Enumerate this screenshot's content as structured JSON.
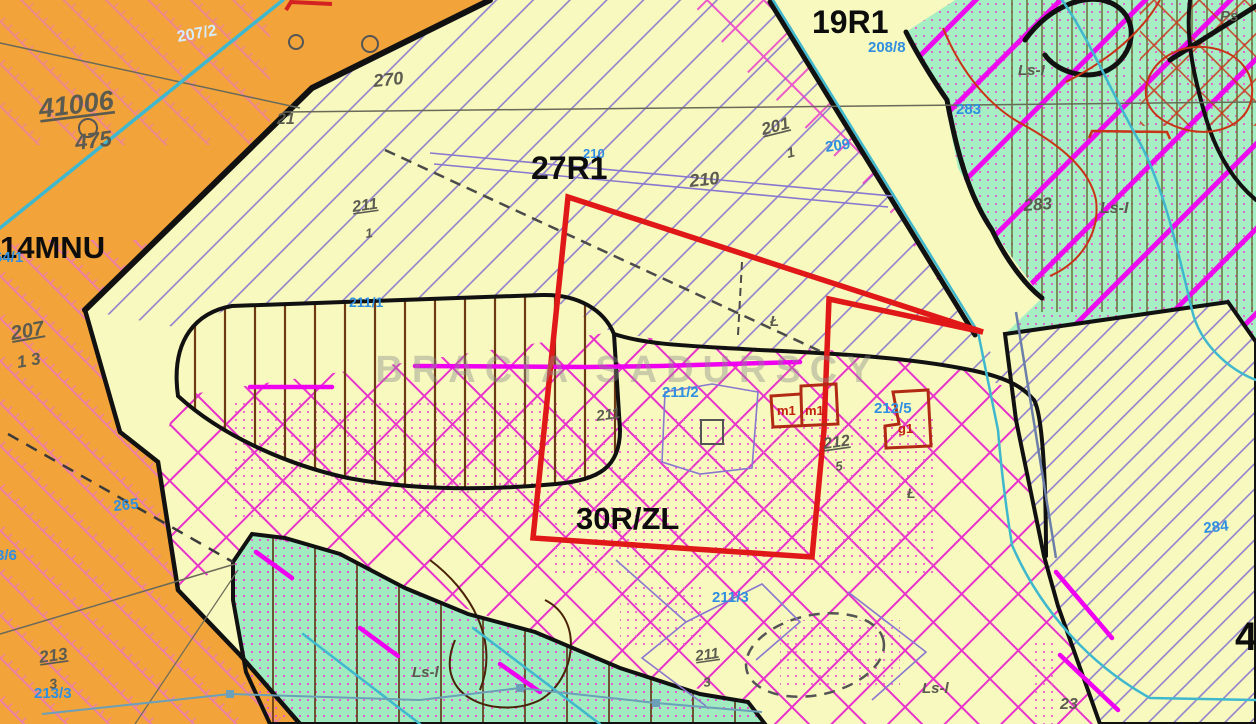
{
  "map": {
    "type": "zoning-plan-map",
    "watermark": "BRACIA SADURSCY",
    "zones": [
      "14MNU",
      "19R1",
      "27R1",
      "30R/ZL"
    ],
    "colors": {
      "orange_area": "#F2A33A",
      "pale_yellow_area": "#F8F9BE",
      "green_area": "#A6EEC3",
      "stream_teal": "#3FB8CE",
      "hatch_violet": "#8878CF",
      "hatch_magenta": "#E832CC",
      "magenta_thick": "#F000F0",
      "plot_boundary_red": "#E01818",
      "building_dark_red": "#B22A14",
      "boundary_black": "#111111",
      "label_gray": "#5B5B50",
      "label_blue": "#2F8FE0"
    },
    "labels": [
      {
        "id": "zone-19r1",
        "t": "19R1",
        "x": 812,
        "y": 33,
        "c": "zone",
        "s": 32
      },
      {
        "id": "zone-27r1",
        "t": "27R1",
        "x": 531,
        "y": 179,
        "c": "zone",
        "s": 32
      },
      {
        "id": "zone-14mnu",
        "t": "14MNU",
        "x": 0,
        "y": 258,
        "c": "zone",
        "s": 31
      },
      {
        "id": "zone-30rzl",
        "t": "30R/ZL",
        "x": 576,
        "y": 529,
        "c": "zone",
        "s": 31
      },
      {
        "id": "zone-4",
        "t": "4",
        "x": 1235,
        "y": 650,
        "c": "zone",
        "s": 40
      },
      {
        "id": "parcel-208-8",
        "t": "208/8",
        "x": 868,
        "y": 52,
        "c": "blue",
        "s": 15
      },
      {
        "id": "parcel-207-2",
        "t": "207/2",
        "x": 178,
        "y": 42,
        "c": "bluelight",
        "s": 16,
        "r": -10
      },
      {
        "id": "parcel-210-blue",
        "t": "210",
        "x": 583,
        "y": 158,
        "c": "blue",
        "s": 13
      },
      {
        "id": "parcel-209",
        "t": "209",
        "x": 826,
        "y": 152,
        "c": "blue",
        "s": 15,
        "r": -8
      },
      {
        "id": "parcel-283-blue",
        "t": "283",
        "x": 956,
        "y": 114,
        "c": "blue",
        "s": 15
      },
      {
        "id": "parcel-211-1",
        "t": "211/1",
        "x": 349,
        "y": 307,
        "c": "blue",
        "s": 14
      },
      {
        "id": "parcel-211-2",
        "t": "211/2",
        "x": 662,
        "y": 397,
        "c": "blue",
        "s": 15
      },
      {
        "id": "parcel-212-5",
        "t": "212/5",
        "x": 874,
        "y": 413,
        "c": "blue",
        "s": 15
      },
      {
        "id": "parcel-211-3",
        "t": "211/3",
        "x": 712,
        "y": 602,
        "c": "blue",
        "s": 15
      },
      {
        "id": "parcel-265",
        "t": "265",
        "x": 114,
        "y": 511,
        "c": "blue",
        "s": 15,
        "r": -6
      },
      {
        "id": "parcel-3-6",
        "t": "3/6",
        "x": -4,
        "y": 560,
        "c": "blue",
        "s": 15
      },
      {
        "id": "parcel-213-3-blue",
        "t": "213/3",
        "x": 34,
        "y": 698,
        "c": "blue",
        "s": 15
      },
      {
        "id": "parcel-64-1",
        "t": "64/1",
        "x": -6,
        "y": 262,
        "c": "blue",
        "s": 15
      },
      {
        "id": "parcel-284",
        "t": "284",
        "x": 1204,
        "y": 533,
        "c": "blue",
        "s": 15,
        "r": -6
      },
      {
        "id": "surv-41006",
        "t": "41006",
        "x": 40,
        "y": 118,
        "c": "gray",
        "s": 27,
        "r": -7,
        "u": 1
      },
      {
        "id": "surv-475",
        "t": "475",
        "x": 76,
        "y": 150,
        "c": "gray",
        "s": 22,
        "r": -7
      },
      {
        "id": "surv-207",
        "t": "207",
        "x": 12,
        "y": 340,
        "c": "gray",
        "s": 20,
        "r": -10,
        "u": 1
      },
      {
        "id": "surv-207-den",
        "t": "1 3",
        "x": 18,
        "y": 368,
        "c": "gray",
        "s": 17,
        "r": -10
      },
      {
        "id": "surv-201",
        "t": "201",
        "x": 763,
        "y": 135,
        "c": "gray",
        "s": 17,
        "r": -14,
        "u": 1
      },
      {
        "id": "surv-201-den",
        "t": "1",
        "x": 788,
        "y": 158,
        "c": "gray",
        "s": 14,
        "r": -14
      },
      {
        "id": "surv-270",
        "t": "270",
        "x": 374,
        "y": 87,
        "c": "gray",
        "s": 18,
        "r": -6
      },
      {
        "id": "surv-211a",
        "t": "211",
        "x": 353,
        "y": 212,
        "c": "gray",
        "s": 16,
        "r": -8,
        "u": 1
      },
      {
        "id": "surv-211a-den",
        "t": "1",
        "x": 366,
        "y": 238,
        "c": "gray",
        "s": 13,
        "r": -8
      },
      {
        "id": "surv-210",
        "t": "210",
        "x": 690,
        "y": 187,
        "c": "gray",
        "s": 18,
        "r": -6
      },
      {
        "id": "surv-211b",
        "t": "211",
        "x": 597,
        "y": 421,
        "c": "gray",
        "s": 15,
        "r": -8
      },
      {
        "id": "surv-212",
        "t": "212",
        "x": 824,
        "y": 449,
        "c": "gray",
        "s": 16,
        "r": -8,
        "u": 1
      },
      {
        "id": "surv-212-den",
        "t": "5",
        "x": 836,
        "y": 471,
        "c": "gray",
        "s": 13,
        "r": -8
      },
      {
        "id": "surv-211c",
        "t": "211",
        "x": 696,
        "y": 661,
        "c": "gray",
        "s": 15,
        "r": -8,
        "u": 1
      },
      {
        "id": "surv-211c-den",
        "t": "3",
        "x": 704,
        "y": 687,
        "c": "gray",
        "s": 13,
        "r": -8
      },
      {
        "id": "surv-213",
        "t": "213",
        "x": 40,
        "y": 663,
        "c": "gray",
        "s": 17,
        "r": -8,
        "u": 1
      },
      {
        "id": "surv-213-den",
        "t": "3",
        "x": 50,
        "y": 689,
        "c": "gray",
        "s": 14,
        "r": -8
      },
      {
        "id": "surv-283-gray",
        "t": "283",
        "x": 1024,
        "y": 211,
        "c": "gray",
        "s": 17,
        "r": -4
      },
      {
        "id": "lu-ls1",
        "t": "Ls-I",
        "x": 1100,
        "y": 213,
        "c": "gray",
        "s": 16
      },
      {
        "id": "lu-ls2",
        "t": "Ls-I",
        "x": 1018,
        "y": 75,
        "c": "gray",
        "s": 15
      },
      {
        "id": "lu-ls3",
        "t": "Ls-l",
        "x": 412,
        "y": 677,
        "c": "gray",
        "s": 15
      },
      {
        "id": "lu-ls4",
        "t": "Ls-l",
        "x": 922,
        "y": 693,
        "c": "gray",
        "s": 15
      },
      {
        "id": "lu-ps",
        "t": "Ps",
        "x": 1220,
        "y": 21,
        "c": "gray",
        "s": 15
      },
      {
        "id": "lu-meadow1",
        "t": "Ł",
        "x": 770,
        "y": 326,
        "c": "gray",
        "s": 15
      },
      {
        "id": "lu-meadow2",
        "t": "Ł",
        "x": 907,
        "y": 498,
        "c": "gray",
        "s": 14
      },
      {
        "id": "surv-23",
        "t": "23",
        "x": 1060,
        "y": 709,
        "c": "gray",
        "s": 16
      },
      {
        "id": "surv-21",
        "t": "21",
        "x": 277,
        "y": 124,
        "c": "gray",
        "s": 16
      },
      {
        "id": "bldg-m1a",
        "t": "m1",
        "x": 777,
        "y": 415,
        "c": "red",
        "s": 13
      },
      {
        "id": "bldg-m1b",
        "t": "m1",
        "x": 805,
        "y": 415,
        "c": "red",
        "s": 13
      },
      {
        "id": "bldg-g1",
        "t": "g1",
        "x": 898,
        "y": 433,
        "c": "red",
        "s": 13
      },
      {
        "id": "watermark",
        "t": "BRACIA SADURSCY",
        "x": 628,
        "y": 382,
        "c": "wm",
        "s": 38,
        "a": "middle"
      }
    ]
  }
}
